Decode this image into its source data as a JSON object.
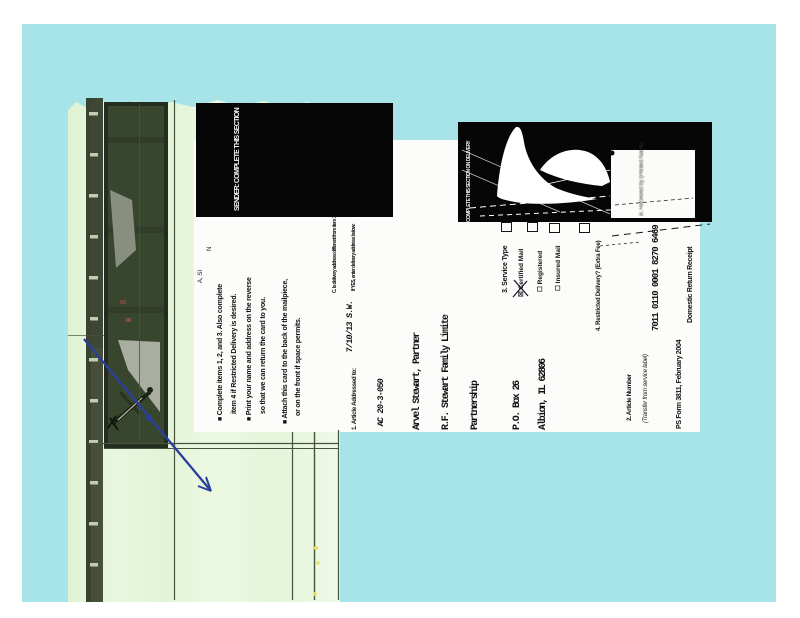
{
  "colors": {
    "mat": "#a6e4e9",
    "envelope": "#e4f5da",
    "redaction_block": "#060606",
    "pen_blue": "#2b3f9e",
    "photo_green": "#39462e"
  },
  "card": {
    "sender": {
      "header": "SENDER: COMPLETE THIS SECTION",
      "instructions": [
        "■ Complete items 1, 2, and 3. Also complete",
        "item 4 if Restricted Delivery is desired.",
        "■ Print your name and address on the reverse",
        "so that we can return the card to you.",
        "■ Attach this card to the back of the mailpiece,",
        "or on the front if space permits."
      ],
      "fragments": [
        "N",
        "A, SI"
      ],
      "article_addressed_label": "1. Article Addressed to:",
      "handwritten_note": "7/10/13 S.W.",
      "handwritten_code": "AC 20-3-050",
      "addressee_lines": [
        "Arvel Stewart, Partner",
        "R.F. Stewart Family Limite",
        "Partnership",
        "P.O. Box 26",
        "Albion, IL 62806"
      ]
    },
    "delivery": {
      "header": "COMPLETE THIS SECTION ON DELIVERY",
      "received_by_label": "B. Received by (Printed Name)",
      "delivery_address_q1": "C. Is delivery address different from item 1?",
      "delivery_address_q2": "If YES, enter delivery address below:",
      "service_type_label": "3. Service Type",
      "service_certified": "☒ Certified Mail",
      "service_registered": "☐ Registered",
      "service_insured": "☐ Insured Mail",
      "restricted_label": "4. Restricted Delivery? (Extra Fee)",
      "article_number_label": "2. Article Number",
      "transfer_label": "(Transfer from service label)",
      "tracking_number": "7011 0110 0001 8270 6469",
      "form_id": "PS Form 3811, February 2004",
      "form_name": "Domestic Return Receipt"
    }
  }
}
